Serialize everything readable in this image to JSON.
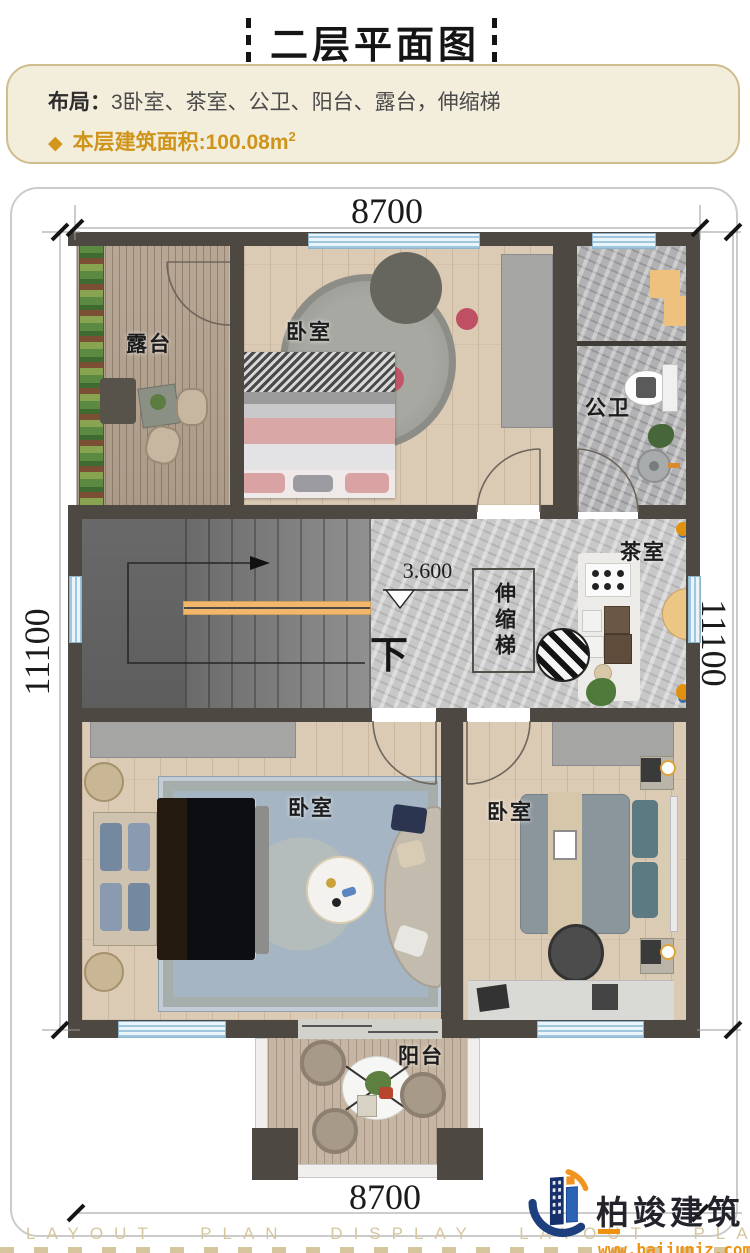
{
  "title": {
    "text": "二层平面图"
  },
  "info": {
    "layout_label": "布局：",
    "layout_value": "3卧室、茶室、公卫、阳台、露台，伸缩梯",
    "bullet": "◆",
    "area_label": "本层建筑面积:",
    "area_value": "100.08m",
    "area_exp": "2"
  },
  "dims": {
    "top": "8700",
    "bottom": "8700",
    "left": "11100",
    "right": "11100"
  },
  "labels": {
    "terrace": "露台",
    "bedroom_top": "卧室",
    "bathroom": "公卫",
    "tea_room": "茶室",
    "retractable_stair": "伸缩梯",
    "elevation": "3.600",
    "down": "下",
    "bedroom_left": "卧室",
    "bedroom_right": "卧室",
    "balcony": "阳台"
  },
  "footer": {
    "watermark": "LAYOUT PLAN DISPLAY LAYOUT PLAN DISPLAY",
    "brand": "柏竣建筑",
    "site": "www.baijunjz.com"
  },
  "colors": {
    "accent_gold": "#d3961c",
    "wall": "#4e4842",
    "window_blue": "#bfdcee",
    "brand_navy": "#1d3f7d",
    "brand_orange": "#ef9212"
  }
}
